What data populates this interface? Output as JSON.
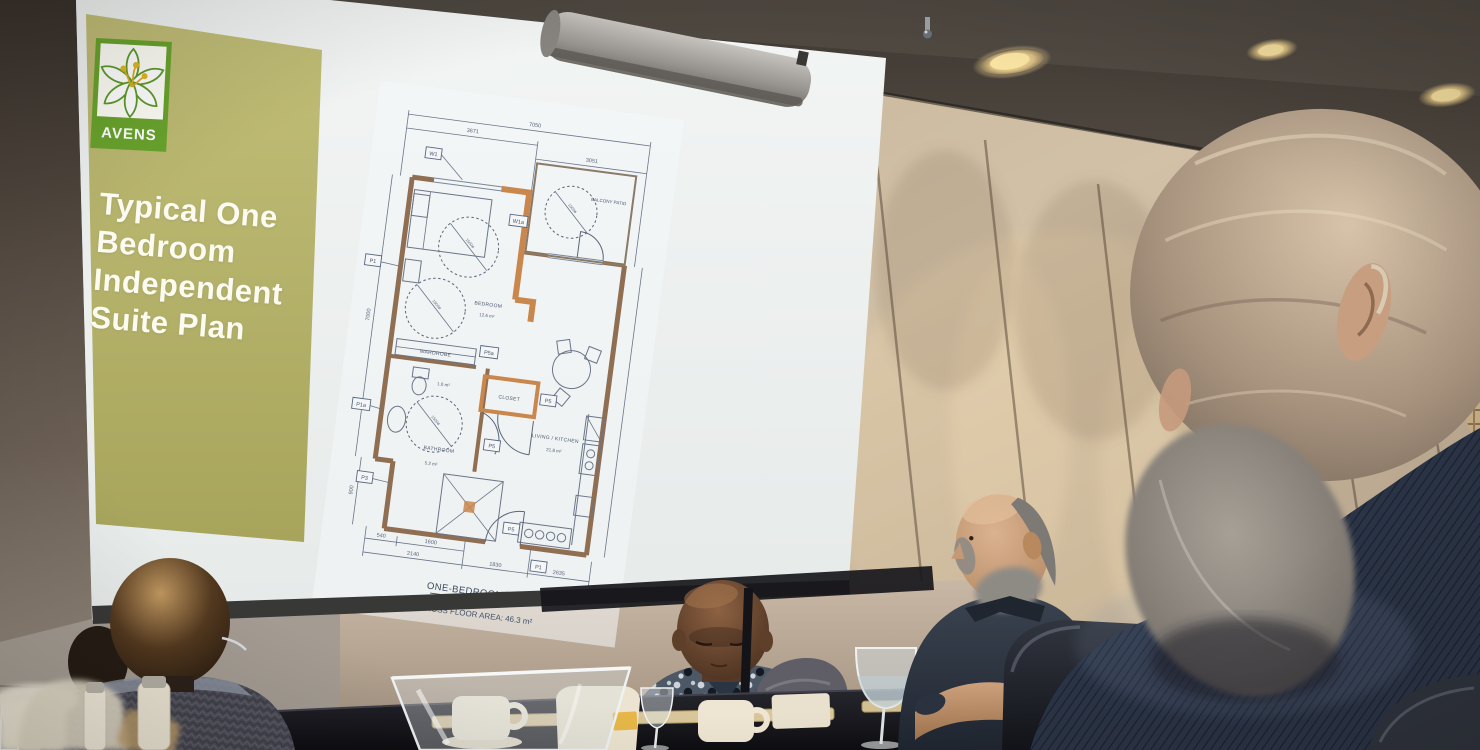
{
  "scene": {
    "setting": "conference room audience watching projected slide",
    "ceiling_light_count": "3"
  },
  "slide": {
    "logo_text": "AVENS",
    "title_lines": [
      "Typical One",
      "Bedroom",
      "Independent",
      "Suite Plan"
    ],
    "accent_olive": "#b3b06a",
    "logo_green": "#69a32d",
    "stamen_yellow": "#e0b222",
    "title_color": "#fbfbf2"
  },
  "floor_plan": {
    "unit_title": "ONE-BEDROOM UNIT",
    "gross_area": "GROSS FLOOR AREA: 46.3 m²",
    "rooms": [
      {
        "name": "BEDROOM",
        "area": "12.6 m²"
      },
      {
        "name": "BALCONY PATIO",
        "area": ""
      },
      {
        "name": "WARDROBE",
        "area": ""
      },
      {
        "name": "CLOSET",
        "area": "1.0 m²"
      },
      {
        "name": "BATHROOM",
        "area": "5.2 m²"
      },
      {
        "name": "LIVING / KITCHEN",
        "area": "21.8 m²"
      }
    ],
    "turning_circle": "1500ø",
    "dims_top": [
      "3671",
      "7050",
      "3051"
    ],
    "dims_left": [
      "7000",
      "900"
    ],
    "dims_bottom": [
      "540",
      "1600",
      "2140",
      "1830",
      "2635"
    ],
    "tags": [
      "W1",
      "W1a",
      "P1",
      "P5a",
      "P5",
      "P1a",
      "P5",
      "P3",
      "P5",
      "P1"
    ],
    "wall_color": "#8f6e52",
    "highlight_wall_color": "#c9874e"
  }
}
